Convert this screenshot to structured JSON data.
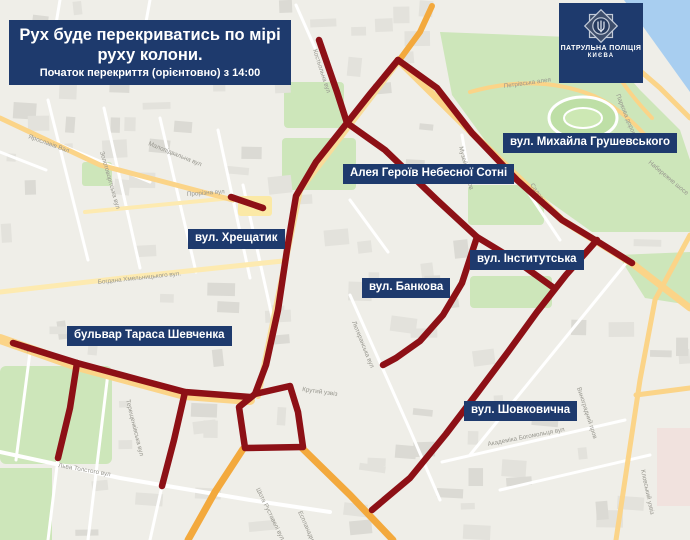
{
  "banner": {
    "title_line1": "Рух буде перекриватись по мірі",
    "title_line2": "руху колони.",
    "subtitle": "Початок перекриття (орієнтовно) з 14:00"
  },
  "police": {
    "line1": "ПАТРУЛЬНА ПОЛІЦІЯ",
    "line2": "КИЄВА"
  },
  "colors": {
    "navy": "#1e3a6d",
    "route_red": "#8d1016",
    "land": "#efeee8",
    "water": "#a8cef0",
    "park": "#cde6ba",
    "road_yellow": "#fbd488",
    "road_orange": "#f3a93d",
    "building": "#e2e1db"
  },
  "street_labels": [
    {
      "text": "вул. Михайла Грушевського",
      "x": 503,
      "y": 133
    },
    {
      "text": "Алея Героїв Небесної Сотні",
      "x": 343,
      "y": 164
    },
    {
      "text": "вул. Хрещатик",
      "x": 188,
      "y": 229
    },
    {
      "text": "вул. Інститутська",
      "x": 470,
      "y": 250
    },
    {
      "text": "вул. Банкова",
      "x": 362,
      "y": 278
    },
    {
      "text": "бульвар Тараса Шевченка",
      "x": 67,
      "y": 326
    },
    {
      "text": "вул. Шовковична",
      "x": 464,
      "y": 401
    }
  ],
  "closed_routes": [
    {
      "name": "Хрещатик",
      "points": [
        [
          398,
          60
        ],
        [
          370,
          94
        ],
        [
          347,
          123
        ],
        [
          316,
          162
        ],
        [
          296,
          196
        ],
        [
          287,
          250
        ],
        [
          278,
          310
        ],
        [
          266,
          365
        ],
        [
          255,
          394
        ]
      ]
    },
    {
      "name": "вул. Михайла Грушевського",
      "points": [
        [
          398,
          60
        ],
        [
          437,
          88
        ],
        [
          472,
          133
        ],
        [
          517,
          180
        ],
        [
          562,
          220
        ],
        [
          600,
          243
        ],
        [
          632,
          263
        ]
      ]
    },
    {
      "name": "Алея Героїв Небесної Сотні",
      "points": [
        [
          319,
          40
        ],
        [
          337,
          92
        ],
        [
          347,
          123
        ],
        [
          385,
          150
        ],
        [
          437,
          200
        ],
        [
          477,
          237
        ],
        [
          462,
          283
        ],
        [
          443,
          315
        ],
        [
          420,
          341
        ],
        [
          396,
          358
        ],
        [
          383,
          365
        ]
      ]
    },
    {
      "name": "вул. Інститутська",
      "points": [
        [
          477,
          237
        ],
        [
          515,
          260
        ],
        [
          554,
          288
        ]
      ]
    },
    {
      "name": "вул. Шовковична",
      "points": [
        [
          597,
          240
        ],
        [
          566,
          275
        ],
        [
          537,
          312
        ],
        [
          508,
          352
        ],
        [
          478,
          392
        ],
        [
          446,
          434
        ],
        [
          410,
          478
        ],
        [
          372,
          510
        ]
      ]
    },
    {
      "name": "Прорізна",
      "points": [
        [
          231,
          197
        ],
        [
          263,
          208
        ]
      ]
    },
    {
      "name": "бульвар Тараса Шевченка",
      "points": [
        [
          13,
          343
        ],
        [
          77,
          363
        ],
        [
          140,
          380
        ],
        [
          185,
          392
        ],
        [
          250,
          397
        ]
      ]
    },
    {
      "name": "відгалуження 1",
      "points": [
        [
          77,
          363
        ],
        [
          70,
          408
        ],
        [
          58,
          458
        ]
      ]
    },
    {
      "name": "відгалуження 2",
      "points": [
        [
          185,
          392
        ],
        [
          174,
          440
        ],
        [
          162,
          486
        ]
      ]
    },
    {
      "name": "Бессарабське кільце",
      "points": [
        [
          255,
          394
        ],
        [
          290,
          386
        ],
        [
          298,
          412
        ],
        [
          303,
          447
        ],
        [
          245,
          448
        ],
        [
          239,
          407
        ],
        [
          255,
          394
        ]
      ]
    }
  ],
  "map_street_names": [
    {
      "t": "Ярославів Вал",
      "x": 28,
      "y": 138,
      "r": 20
    },
    {
      "t": "Золотоворітська вул",
      "x": 100,
      "y": 152,
      "r": 74
    },
    {
      "t": "Малопідвальна вул",
      "x": 148,
      "y": 145,
      "r": 22
    },
    {
      "t": "Прорізна вул",
      "x": 187,
      "y": 196,
      "r": -4
    },
    {
      "t": "Богдана Хмельницького вул.",
      "x": 98,
      "y": 284,
      "r": -6
    },
    {
      "t": "Тараса Шевченка бульв",
      "x": 20,
      "y": 349,
      "r": 16
    },
    {
      "t": "Льва Толстого вул",
      "x": 58,
      "y": 467,
      "r": 10
    },
    {
      "t": "Терещенківська вул",
      "x": 126,
      "y": 400,
      "r": 76
    },
    {
      "t": "Шота Руставелі вул",
      "x": 256,
      "y": 489,
      "r": 64
    },
    {
      "t": "Еспланадна вул",
      "x": 298,
      "y": 512,
      "r": 66
    },
    {
      "t": "Крутий узвіз",
      "x": 302,
      "y": 391,
      "r": 8
    },
    {
      "t": "Набережне шосе",
      "x": 648,
      "y": 163,
      "r": 40
    },
    {
      "t": "Паркова дорога",
      "x": 616,
      "y": 95,
      "r": 68
    },
    {
      "t": "Петрівська алея",
      "x": 504,
      "y": 88,
      "r": -8
    },
    {
      "t": "Музейний пров",
      "x": 459,
      "y": 147,
      "r": 76
    },
    {
      "t": "Академіка Богомольця вул",
      "x": 488,
      "y": 446,
      "r": -11
    },
    {
      "t": "Виноградний пров",
      "x": 577,
      "y": 388,
      "r": 72
    },
    {
      "t": "Кловський узвіз",
      "x": 641,
      "y": 470,
      "r": 78
    },
    {
      "t": "Лютеранська вул",
      "x": 352,
      "y": 322,
      "r": 68
    },
    {
      "t": "Костьольна вул",
      "x": 313,
      "y": 50,
      "r": 72
    },
    {
      "t": "Садова вул",
      "x": 530,
      "y": 185,
      "r": 55
    }
  ]
}
